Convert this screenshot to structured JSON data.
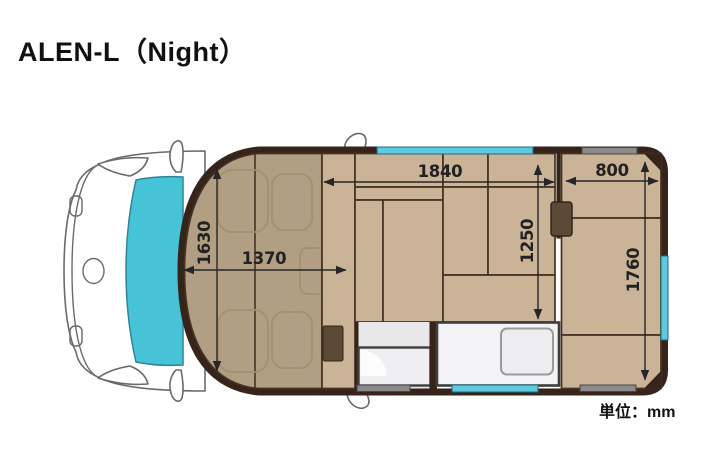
{
  "title": "ALEN-L（Night）",
  "unit_label": "単位：mm",
  "dimensions": {
    "front_bed_width": "1630",
    "front_bed_length": "1370",
    "main_bed_length": "1840",
    "main_bed_width": "1250",
    "rear_bed_length": "800",
    "rear_bed_width": "1760"
  },
  "colors": {
    "wall": "#36241b",
    "cushion": "#cab397",
    "front_bed": "#b19e83",
    "window_cyan": "#5ecadf",
    "windshield": "#47c3d8",
    "window_gray": "#8b8b8b",
    "box_brown": "#5c4936",
    "fixture_white": "#f3f3f5"
  }
}
